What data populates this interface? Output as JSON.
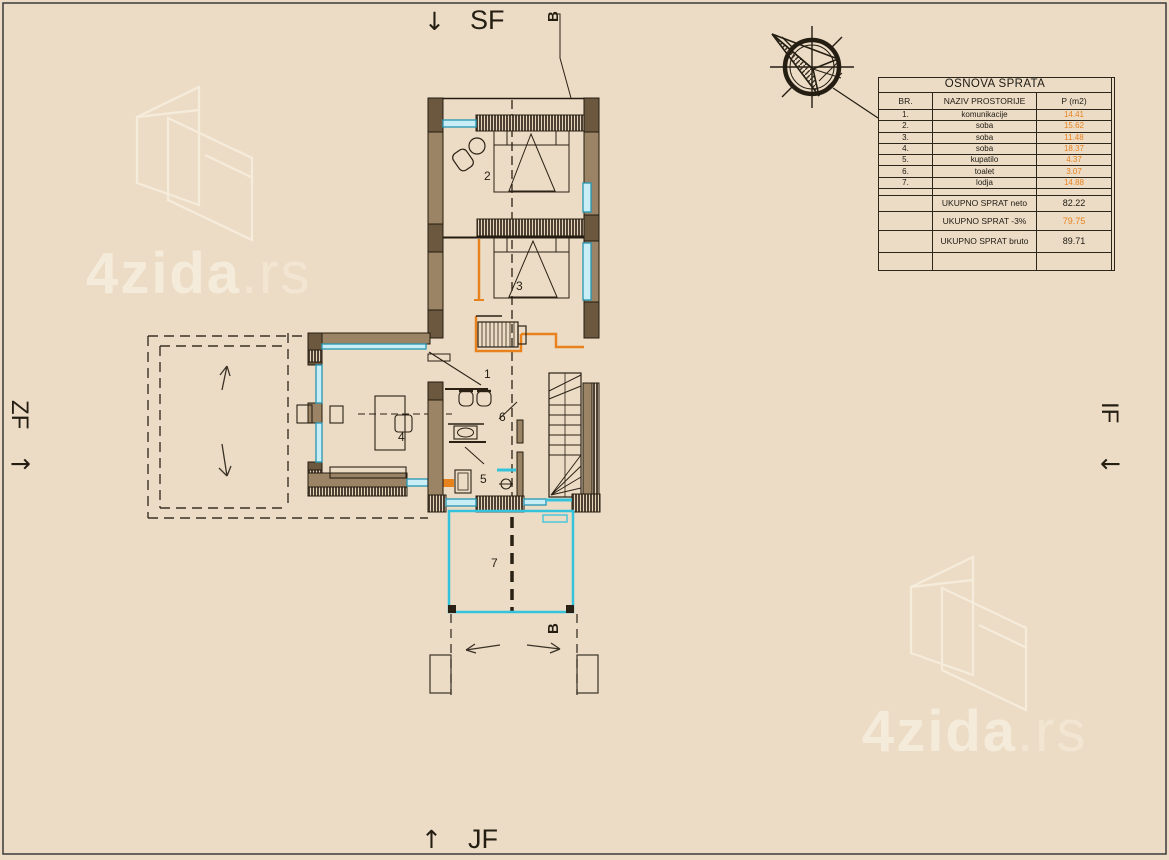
{
  "facades": {
    "top": "SF",
    "bottom": "JF",
    "left": "ZF",
    "right": "IF",
    "arrow_down": "↓",
    "arrow_up": "↑",
    "arrow_right": "→",
    "arrow_left": "←"
  },
  "section_marker": "B",
  "watermark": {
    "brand": "4zida",
    "tld": ".rs"
  },
  "plan": {
    "rooms": [
      "1",
      "2",
      "3",
      "4",
      "5",
      "6",
      "7"
    ]
  },
  "table": {
    "title": "OSNOVA SPRATA",
    "columns": [
      "BR.",
      "NAZIV PROSTORIJE",
      "P (m2)"
    ],
    "rows": [
      {
        "br": "1.",
        "name": "komunikacije",
        "area": "14.41"
      },
      {
        "br": "2.",
        "name": "soba",
        "area": "15.62"
      },
      {
        "br": "3.",
        "name": "soba",
        "area": "11.48"
      },
      {
        "br": "4.",
        "name": "soba",
        "area": "18.37"
      },
      {
        "br": "5.",
        "name": "kupatilo",
        "area": "4.37"
      },
      {
        "br": "6.",
        "name": "toalet",
        "area": "3.07"
      },
      {
        "br": "7.",
        "name": "lodja",
        "area": "14.88"
      }
    ],
    "totals": [
      {
        "label": "UKUPNO SPRAT neto",
        "value": "82.22",
        "orange": false
      },
      {
        "label": "UKUPNO SPRAT -3%",
        "value": "79.75",
        "orange": true
      },
      {
        "label": "UKUPNO SPRAT bruto",
        "value": "89.71",
        "orange": false
      }
    ]
  },
  "colors": {
    "background": "#ecdcc6",
    "wall_fill": "#9b8365",
    "wall_dark": "#6b583f",
    "line_dark": "#2a2114",
    "window_cyan": "#35c3dc",
    "window_fill": "#c9eef5",
    "accent_orange": "#e8821c",
    "watermark": "#f7edd d"
  }
}
